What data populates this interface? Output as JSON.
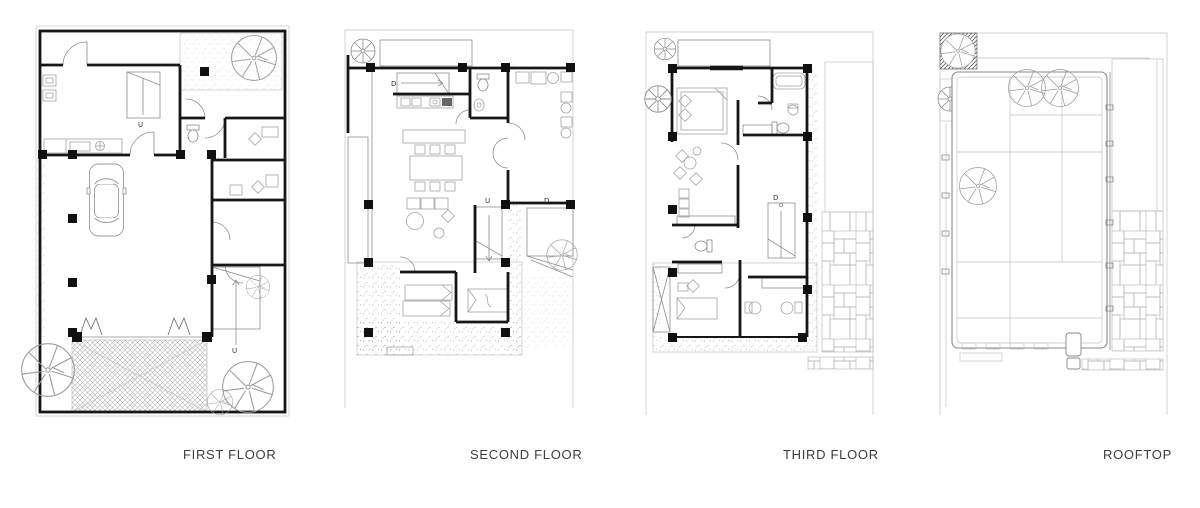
{
  "colors": {
    "background": "#ffffff",
    "walls": "#161616",
    "thin_lines": "#8e8e8e",
    "hatch": "#9a9a9a",
    "label_text": "#3d3d3d"
  },
  "plans": [
    {
      "id": "first-floor",
      "label": "FIRST FLOOR",
      "stair_up_interior": "U",
      "stair_up_exterior": "U"
    },
    {
      "id": "second-floor",
      "label": "SECOND FLOOR",
      "stair_down_kitchen": "D",
      "stair_up_interior": "U",
      "stair_down_exterior": "D"
    },
    {
      "id": "third-floor",
      "label": "THIRD FLOOR",
      "stair_down_interior": "D"
    },
    {
      "id": "rooftop",
      "label": "ROOFTOP"
    }
  ]
}
